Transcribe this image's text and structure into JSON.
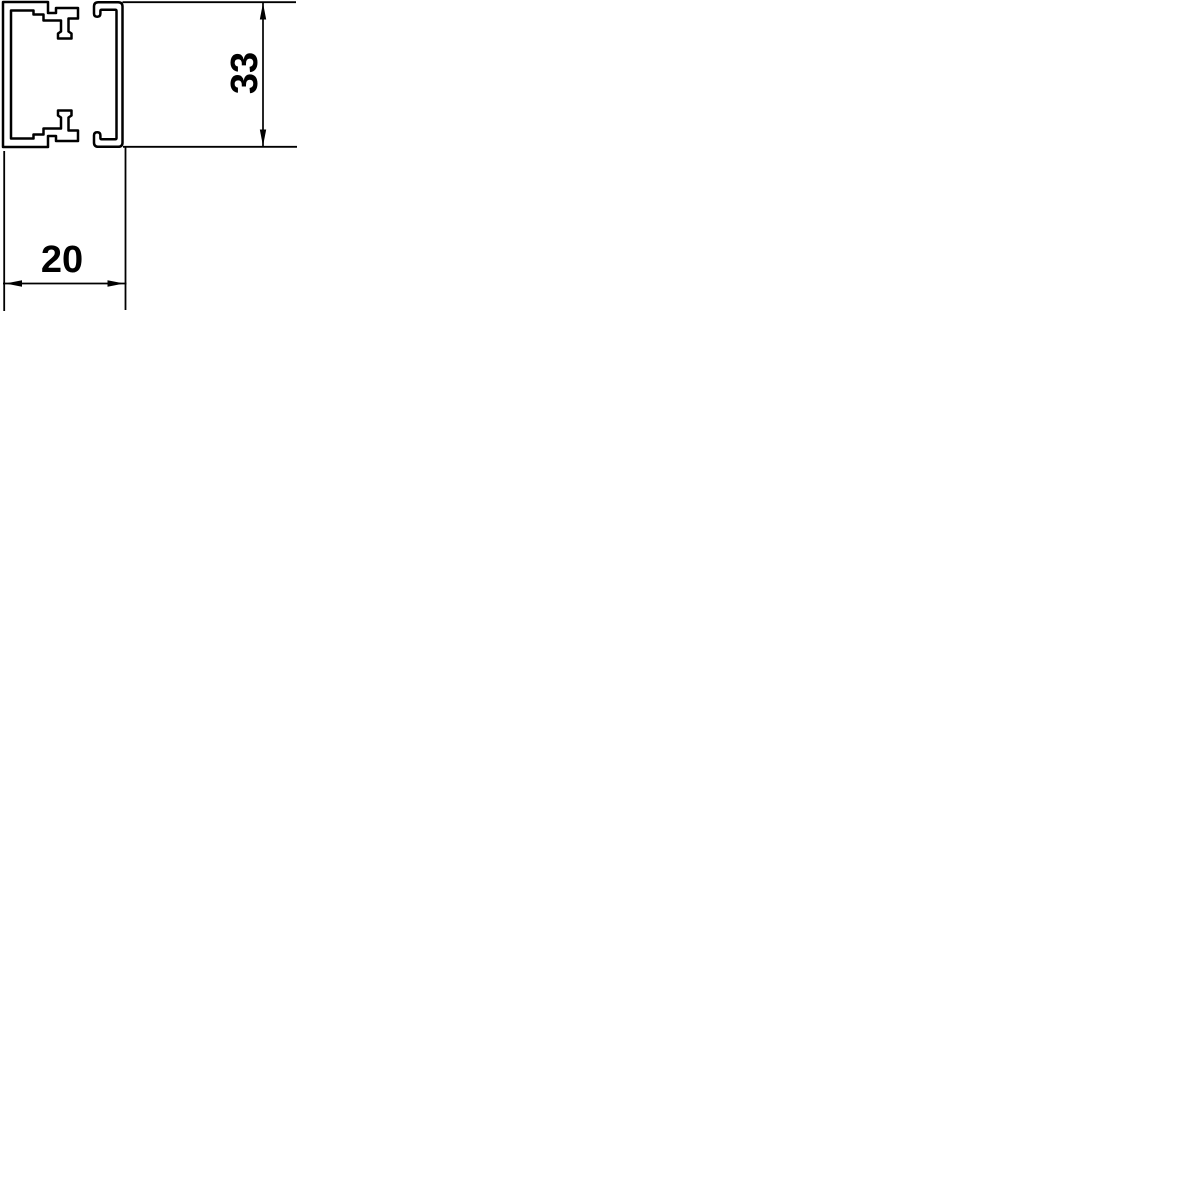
{
  "figure": {
    "description": "Technical cross-section drawing of a mini cable trunking profile: U-shaped base channel with two inward clip latches on the left, snap-on lid with curled hook edges on the right",
    "dim_height": {
      "label": "33",
      "orientation": "vertical",
      "measures": "overall profile height"
    },
    "dim_width": {
      "label": "20",
      "orientation": "horizontal",
      "measures": "overall profile width"
    }
  },
  "colors": {
    "line": "#000000",
    "background": "#ffffff"
  }
}
